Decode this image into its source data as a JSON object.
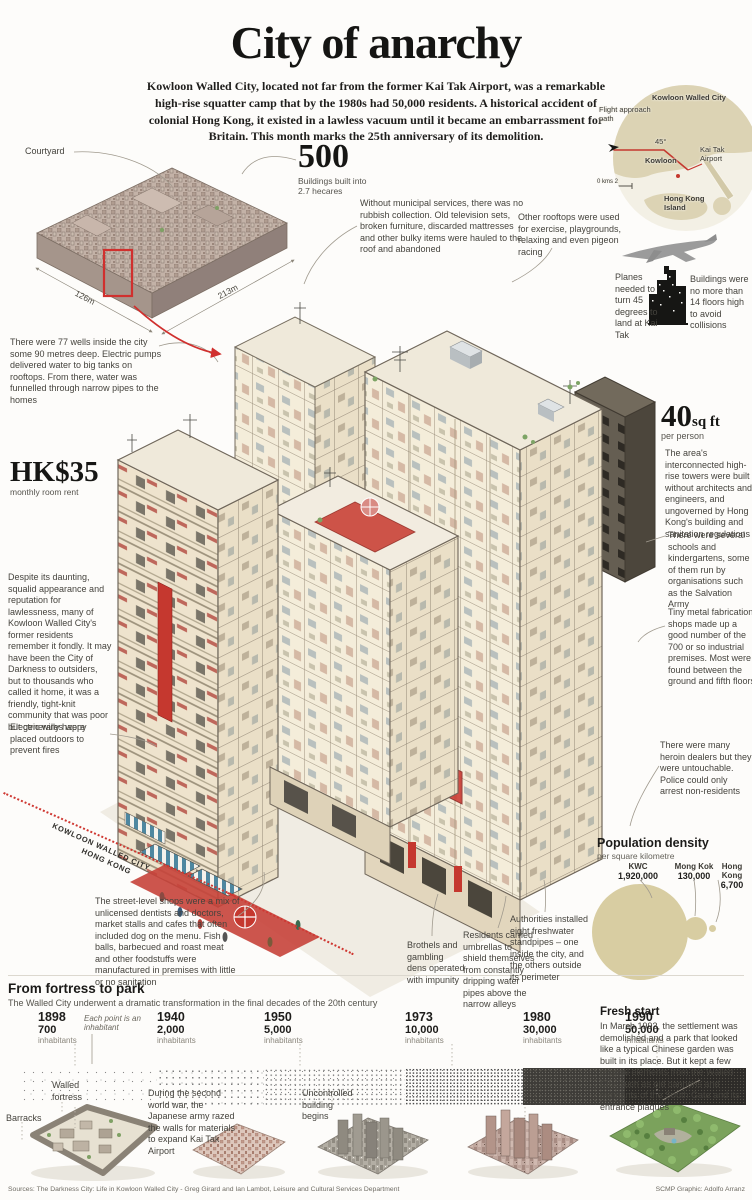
{
  "header": {
    "title": "City of anarchy",
    "intro": "Kowloon Walled City, located not far from the former Kai Tak Airport, was a remarkable high-rise squatter camp that by the 1980s had 50,000 residents. A historical accident of colonial Hong Kong, it existed in a lawless vacuum until it became an embarrassment for Britain. This month marks the 25th anniversary of its demolition."
  },
  "overview": {
    "courtyard_label": "Courtyard",
    "width_label": "126m",
    "depth_label": "213m"
  },
  "stats": {
    "buildings": {
      "value": "500",
      "label": "Buildings built into 2.7 hecares"
    },
    "rent": {
      "value": "HK$35",
      "label": "monthly room rent"
    },
    "space": {
      "value": "40",
      "unit": "sq ft",
      "label": "per person"
    }
  },
  "map": {
    "flight_path": "Flight approach path",
    "kwc": "Kowloon Walled City",
    "angle": "45°",
    "kai_tak": "Kai Tak Airport",
    "kowloon": "Kowloon",
    "hong_kong_island": "Hong Kong Island",
    "scale": "0 kms 2"
  },
  "aviation": {
    "planes": "Planes needed to turn 45 degrees to land at Kai Tak",
    "buildings": "Buildings were no more than 14 floors high to avoid collisions"
  },
  "annotations": {
    "rubbish": "Without municipal services, there was no rubbish collection. Old television sets, broken furniture, discarded mattresses and other bulky items were hauled to the roof and abandoned",
    "rooftops": "Other rooftops were used for exercise, playgrounds, relaxing and even pigeon racing",
    "wells": "There were 77 wells inside the city some 90 metres deep. Electric pumps delivered water to big tanks on rooftops. From there, water was funnelled through narrow pipes to the homes",
    "towers": "The area's interconnected high-rise towers were built without architects and engineers, and ungoverned by Hong Kong's building and sanitation regulations",
    "schools": "There were several schools and kindergartens, some of them run by organisations such as the Salvation Army",
    "metal": "Tiny metal fabrication shops made up a good number of the 700 or so industrial premises. Most were found between the ground and fifth floors",
    "community": "Despite its daunting, squalid appearance and reputation for lawlessness, many of Kowloon Walled City's former residents remember it fondly. It may have been the City of Darkness to outsiders, but to thousands who called it home, it was a friendly, tight-knit community that was poor but generally happy",
    "wires": "Electric wires were placed outdoors to prevent fires",
    "heroin": "There were many heroin dealers but they were untouchable. Police could only arrest non-residents",
    "shops": "The street-level shops were a mix of unlicensed dentists and doctors, market stalls and cafes that often included dog on the menu. Fish balls, barbecued and roast meat and other foodstuffs were manufactured in premises with little or no sanitation",
    "brothels": "Brothels and gambling dens operated with impunity",
    "umbrellas": "Residents carried umbrellas to shield themselves from constantly dripping water pipes above the narrow alleys",
    "standpipes": "Authorities installed eight freshwater standpipes – one inside the city, and the others outside its perimeter"
  },
  "boundary": {
    "line1": "KOWLOON WALLED CITY",
    "line2": "HONG KONG"
  },
  "population": {
    "title": "Population density",
    "subtitle": "per square kilometre",
    "items": [
      {
        "name": "KWC",
        "value": "1,920,000"
      },
      {
        "name": "Mong Kok",
        "value": "130,000"
      },
      {
        "name": "Hong Kong",
        "value": "6,700"
      }
    ]
  },
  "timeline": {
    "title": "From fortress to park",
    "subtitle": "The Walled City underwent a dramatic transformation in the final decades of the 20th century",
    "note": "Each point is an inhabitant",
    "points": [
      {
        "year": "1898",
        "value": "700",
        "unit": "inhabitants"
      },
      {
        "year": "1940",
        "value": "2,000",
        "unit": "inhabitants"
      },
      {
        "year": "1950",
        "value": "5,000",
        "unit": "inhabitants"
      },
      {
        "year": "1973",
        "value": "10,000",
        "unit": "inhabitants"
      },
      {
        "year": "1980",
        "value": "30,000",
        "unit": "inhabitants"
      },
      {
        "year": "1990",
        "value": "50,000",
        "unit": "inhabitants"
      }
    ],
    "captions": {
      "fortress": "Walled fortress",
      "barracks": "Barracks",
      "ww2": "During the second world war, the Japanese army razed the walls for materials to expand Kai Tak Airport",
      "uncontrolled": "Uncontrolled building begins"
    }
  },
  "fresh": {
    "title": "Fresh start",
    "text": "In March 1993, the settlement was demolished and a park that looked like a typical Chinese garden was built in its place. But it kept a few original elements from the Walled City, such as old cannons and remnants of the South Gate and its entrance plaques"
  },
  "footer": {
    "sources": "Sources: The Darkness City: Life in Kowloon Walled City - Greg Girard and Ian Lambot, Leisure and Cultural Services Department",
    "credit": "SCMP Graphic: Adolfo Arranz"
  },
  "colors": {
    "accent_red": "#cf3832",
    "tan": "#d8cda2",
    "ink": "#161614"
  },
  "chart_data": [
    {
      "type": "bubble",
      "title": "Population density",
      "subtitle": "per square kilometre",
      "points": [
        {
          "label": "KWC",
          "value": 1920000
        },
        {
          "label": "Mong Kok",
          "value": 130000
        },
        {
          "label": "Hong Kong",
          "value": 6700
        }
      ]
    },
    {
      "type": "dot-density-timeline",
      "title": "From fortress to park",
      "note": "Each point is an inhabitant",
      "years": [
        1898,
        1940,
        1950,
        1973,
        1980,
        1990
      ],
      "inhabitants": [
        700,
        2000,
        5000,
        10000,
        30000,
        50000
      ],
      "ylabel": "inhabitants"
    }
  ]
}
